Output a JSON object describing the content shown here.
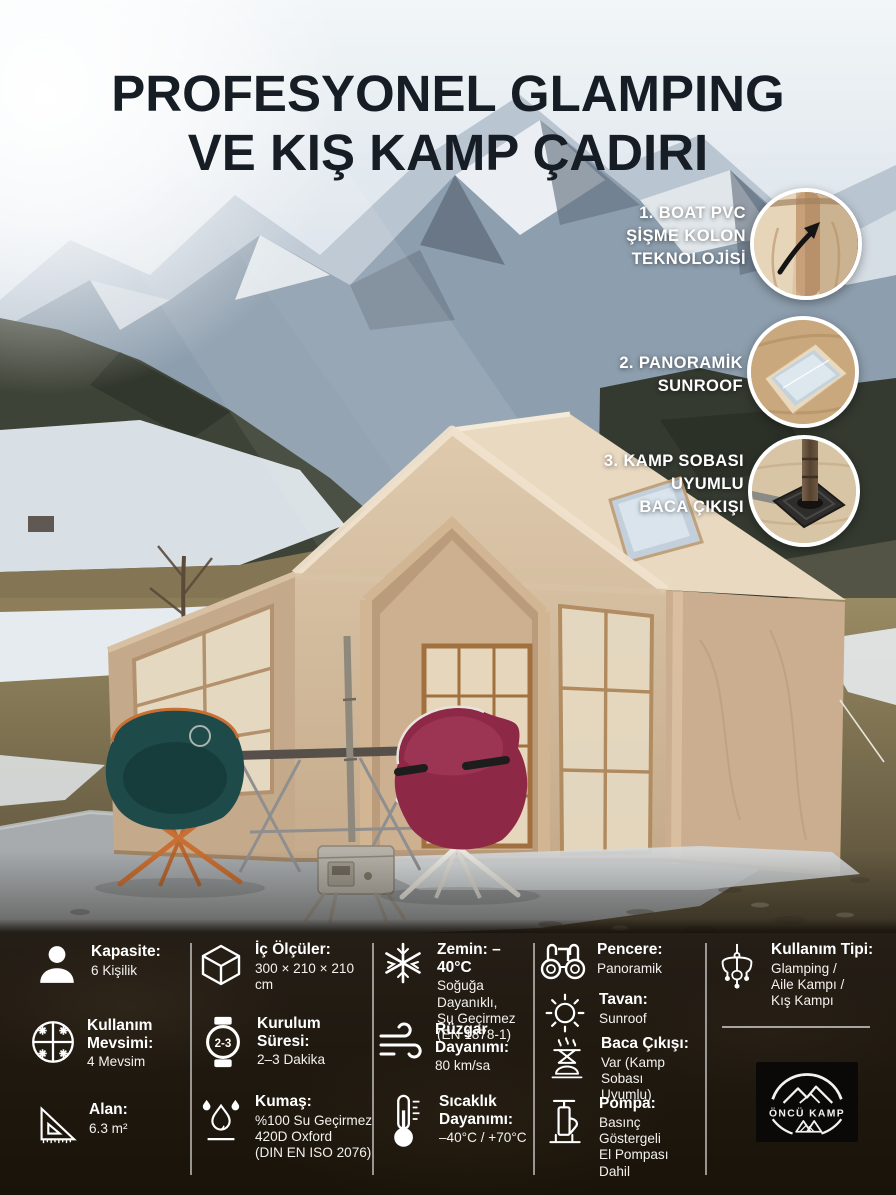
{
  "title": {
    "line1_regular": "PROFESYONEL ",
    "line1_bold": "GLAMPING",
    "line2_regular": "VE ",
    "line2_bold": "KIŞ KAMP ÇADIRI"
  },
  "callouts": [
    {
      "label": "1. BOAT PVC\nŞİŞME KOLON\nTEKNOLOJİSİ",
      "icon": "inflatable-column-photo"
    },
    {
      "label": "2. PANORAMİK\nSUNROOF",
      "icon": "sunroof-photo"
    },
    {
      "label": "3. KAMP SOBASI\nUYUMLU\nBACA ÇIKIŞI",
      "icon": "chimney-outlet-photo"
    }
  ],
  "specs": [
    {
      "icon": "person-icon",
      "label": "Kapasite:",
      "value": "6 Kişilik"
    },
    {
      "icon": "cube-icon",
      "label": "İç Ölçüler:",
      "value": "300 × 210 × 210 cm"
    },
    {
      "icon": "snowflake-icon",
      "label": "Zemin: –40°C",
      "value": "Soğuğa Dayanıklı,\nSu Geçirmez\n(EN 1878-1)"
    },
    {
      "icon": "binoculars-icon",
      "label": "Pencere:",
      "value": "Panoramik"
    },
    {
      "icon": "sun-icon",
      "label": "Tavan:",
      "value": "Sunroof"
    },
    {
      "icon": "chandelier-icon",
      "label": "Kullanım Tipi:",
      "value": "Glamping /\nAile Kampı /\nKış Kampı"
    },
    {
      "icon": "four-seasons-icon",
      "label": "Kullanım\nMevsimi:",
      "value": "4 Mevsim"
    },
    {
      "icon": "watch-icon",
      "label": "Kurulum\nSüresi:",
      "value": "2–3 Dakika",
      "icon_text": "2-3"
    },
    {
      "icon": "wind-icon",
      "label": "Rüzgar\nDayanımı:",
      "value": "80 km/sa"
    },
    {
      "icon": "camp-stove-icon",
      "label": "Baca Çıkışı:",
      "value": "Var (Kamp Sobası\nUyumlu)"
    },
    {
      "icon": "triangle-ruler-icon",
      "label": "Alan:",
      "value": "6.3 m²"
    },
    {
      "icon": "water-drops-icon",
      "label": "Kumaş:",
      "value": "%100 Su Geçirmez\n420D Oxford\n(DIN EN ISO 2076)"
    },
    {
      "icon": "thermometer-icon",
      "label": "Sıcaklık\nDayanımı:",
      "value": "–40°C / +70°C"
    },
    {
      "icon": "hand-pump-icon",
      "label": "Pompa:",
      "value": "Basınç\nGöstergeli\nEl Pompası Dahil"
    }
  ],
  "brand": {
    "name": "ÖNCÜ KAMP"
  },
  "colors": {
    "panel_bg": "#1f1913",
    "title_text": "#171d24",
    "text_on_dark": "#ffffff",
    "tent_fabric": "#d9c4a9",
    "chair_left": "#1e4a49",
    "chair_right": "#8e2847",
    "chair_left_frame": "#c96f33",
    "tarp": "#a9adb0"
  }
}
